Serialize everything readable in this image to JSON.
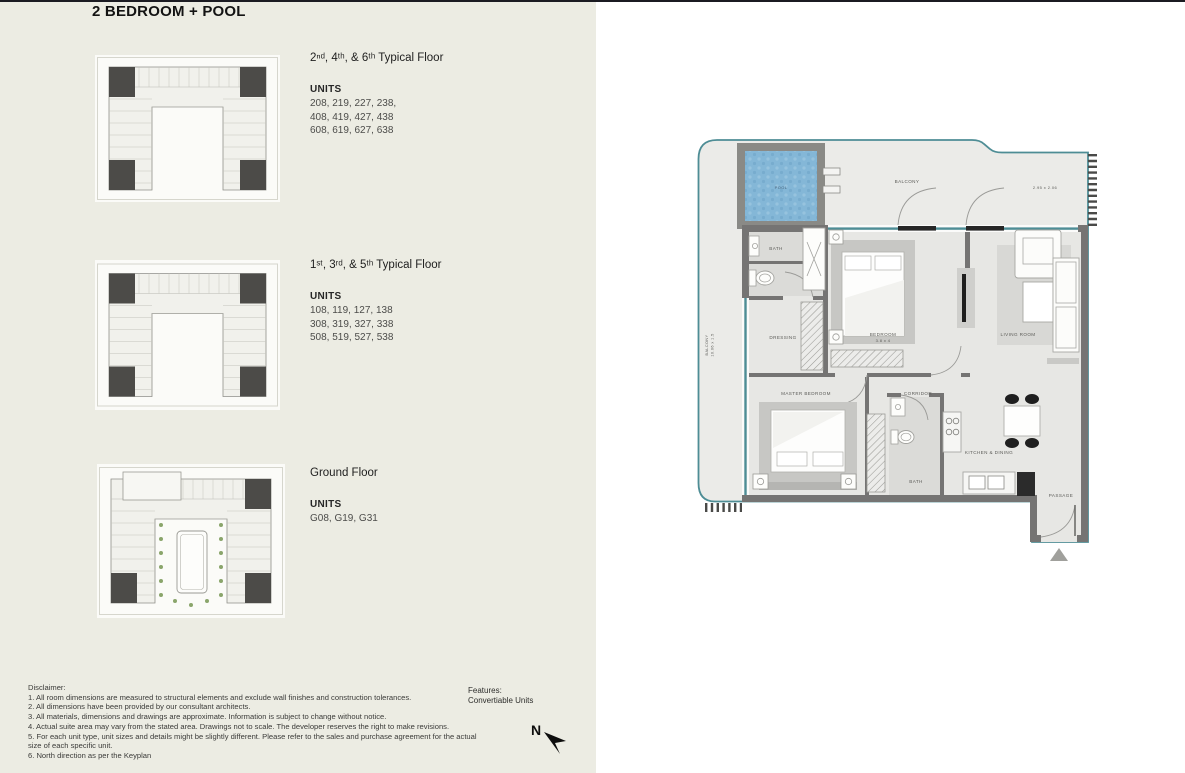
{
  "title": "2 BEDROOM + POOL",
  "sections": [
    {
      "heading": "2ⁿᵈ, 4ᵗʰ, & 6ᵗʰ Typical Floor",
      "units_label": "UNITS",
      "units": [
        "208, 219, 227, 238,",
        "408, 419, 427, 438",
        "608, 619, 627, 638"
      ]
    },
    {
      "heading": "1ˢᵗ, 3ʳᵈ, & 5ᵗʰ Typical Floor",
      "units_label": "UNITS",
      "units": [
        "108, 119, 127, 138",
        "308, 319, 327, 338",
        "508, 519, 527, 538"
      ]
    },
    {
      "heading": "Ground Floor",
      "units_label": "UNITS",
      "units": [
        "G08, G19, G31"
      ]
    }
  ],
  "disclaimer": {
    "label": "Disclaimer:",
    "items": [
      "1. All room dimensions are measured to structural elements and exclude wall finishes and construction tolerances.",
      "2. All dimensions have been provided by our consultant architects.",
      "3. All materials, dimensions and drawings are approximate. Information is subject to change without notice.",
      "4. Actual suite area may vary from the stated area. Drawings not to scale. The developer reserves the right to make revisions.",
      "5. For each unit type, unit sizes and details might be slightly different. Please refer to the sales and purchase agreement for the actual size of each specific unit.",
      "6. North direction as per the Keyplan"
    ]
  },
  "features": {
    "label": "Features:",
    "value": "Convertiable Units"
  },
  "north": {
    "label": "N"
  },
  "plan": {
    "pool": "POOL",
    "balcony_top": "BALCONY",
    "balcony_top_dim": "2.95 x 2.06",
    "balcony_left": "BALCONY",
    "balcony_left_dim": "10.06 x 1.5",
    "bath_1": "BATH",
    "dressing": "DRESSING",
    "bedroom": "BEDROOM",
    "bedroom_dim": "3.8 x 4",
    "living_room": "LIVING ROOM",
    "master_bedroom": "MASTER BEDROOM",
    "corridor": "CORRIDOR",
    "bath_2": "BATH",
    "kitchen_dining": "KITCHEN & DINING",
    "passage": "PASSAGE"
  },
  "colors": {
    "panel_bg": "#ecece3",
    "wall_gray": "#757473",
    "glass_teal": "#4e8d95",
    "pool_blue": "#84b7d7",
    "keyplan_highlight": "#4c4b48"
  }
}
